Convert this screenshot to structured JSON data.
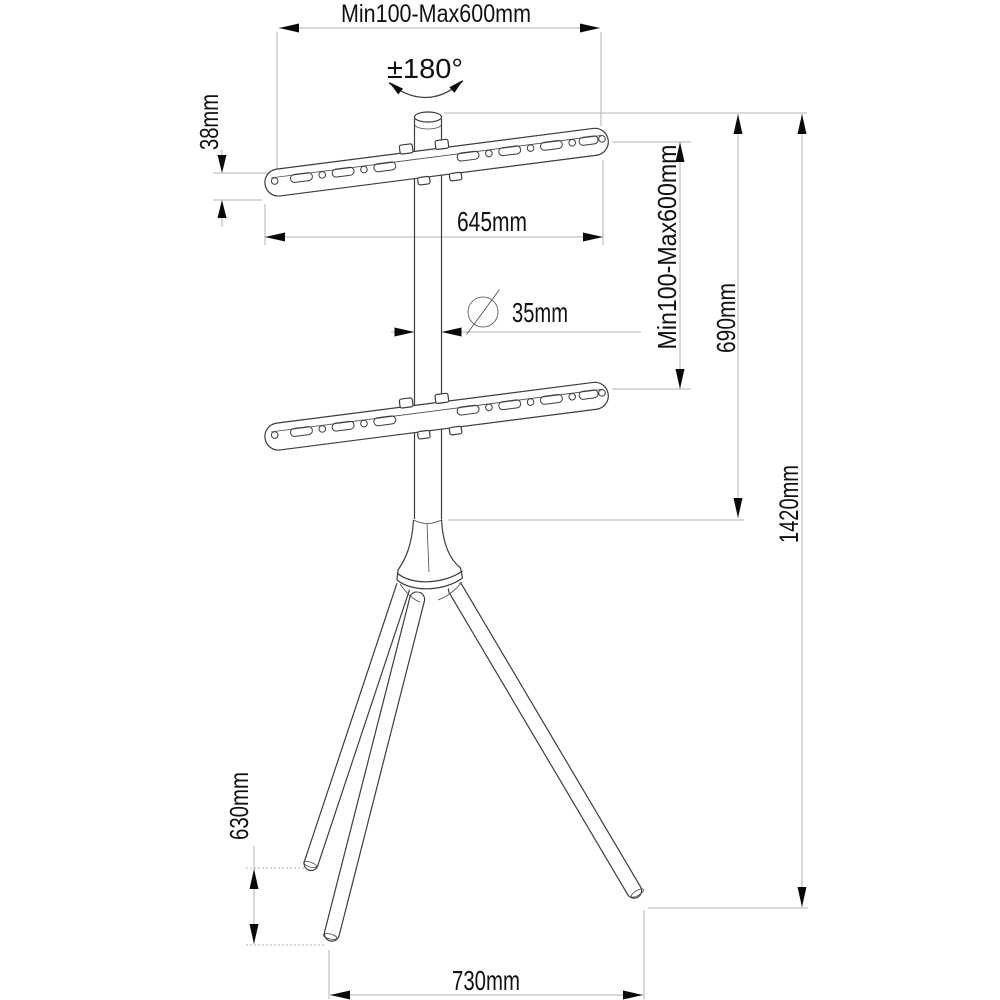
{
  "dims": {
    "top_span": "Min100-Max600mm",
    "swivel": "±180°",
    "bar_height": "38mm",
    "bar_length": "645mm",
    "pole_diameter": "35mm",
    "vertical_span": "Min100-Max600mm",
    "mid_height": "690mm",
    "total_height": "1420mm",
    "leg_height": "630mm",
    "base_width": "730mm"
  }
}
